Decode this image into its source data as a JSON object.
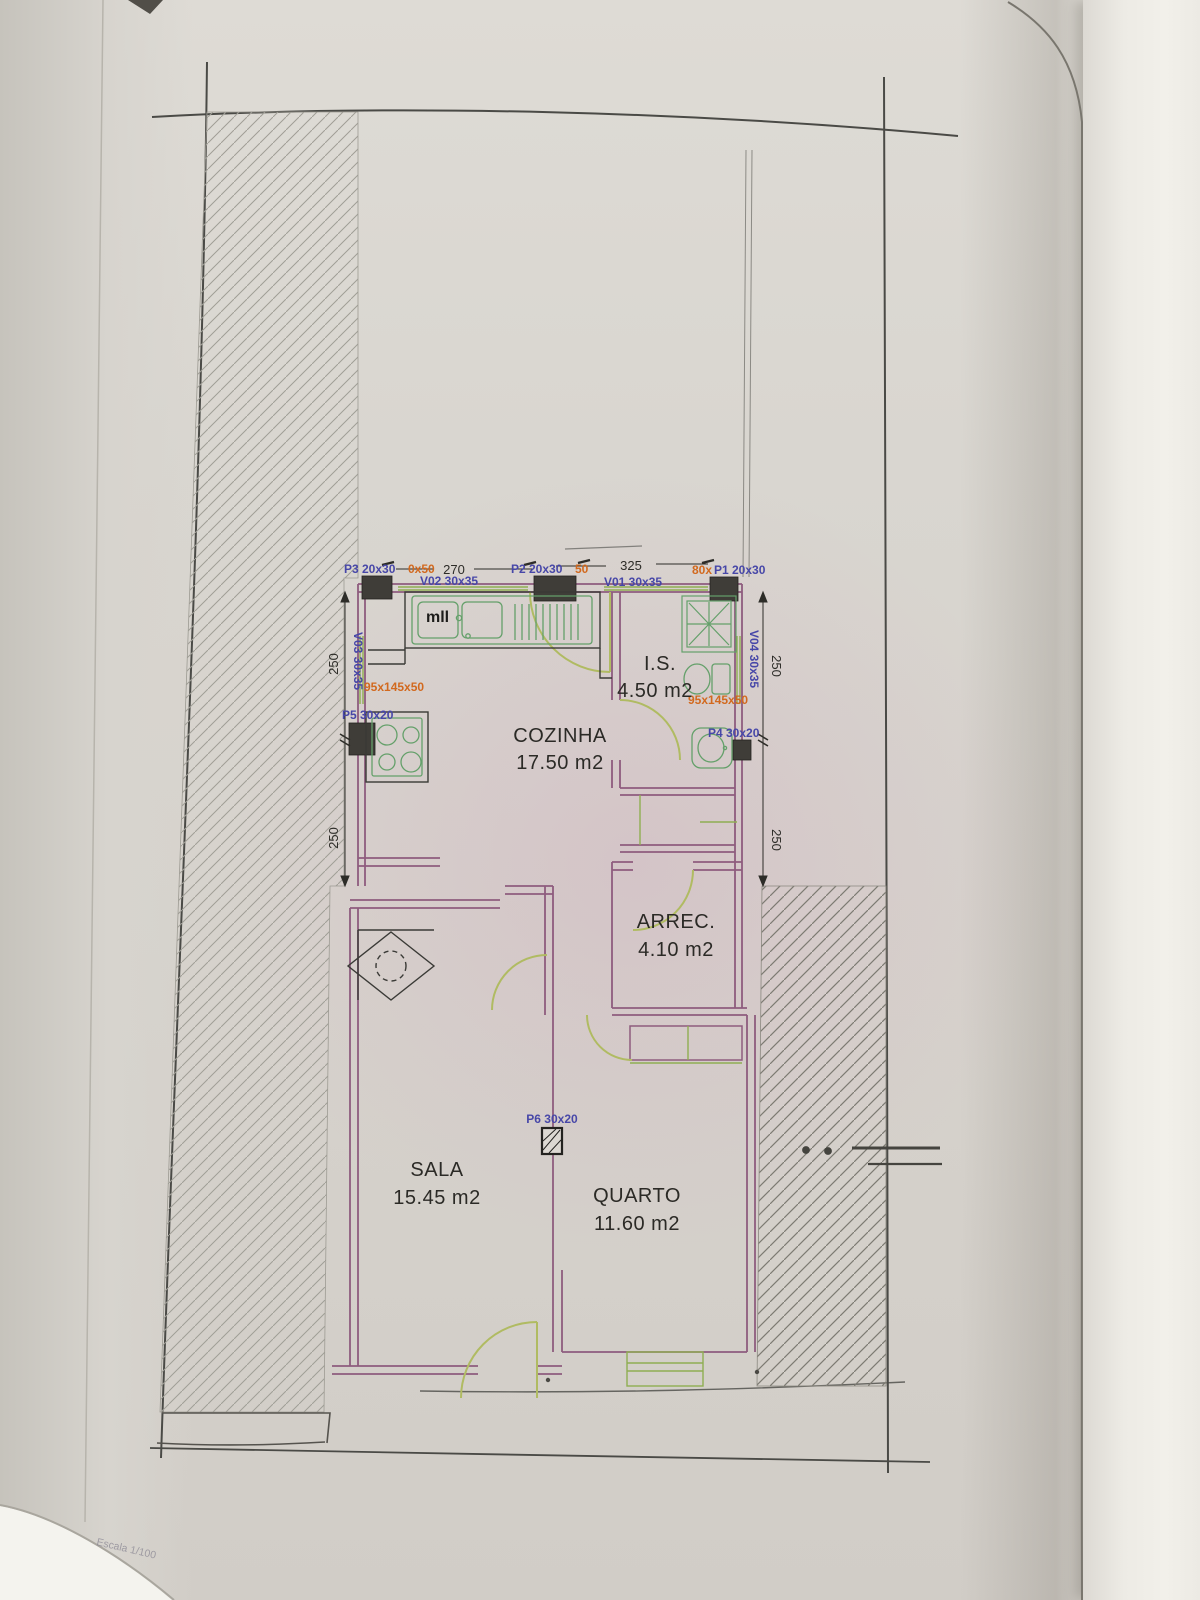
{
  "document": {
    "kind": "architectural floor plan photograph",
    "scale_note": "Escala 1/100"
  },
  "rooms": [
    {
      "name": "COZINHA",
      "area": "17.50 m2"
    },
    {
      "name": "I.S.",
      "area": "4.50 m2"
    },
    {
      "name": "ARREC.",
      "area": "4.10 m2"
    },
    {
      "name": "SALA",
      "area": "15.45 m2"
    },
    {
      "name": "QUARTO",
      "area": "11.60 m2"
    }
  ],
  "doors": [
    {
      "label": "P3 20x30",
      "extra": "0x50"
    },
    {
      "label": "P2 20x30",
      "extra": "50"
    },
    {
      "label": "P1 20x30",
      "extra": "80x"
    },
    {
      "label": "P4 30x20",
      "extra": ""
    },
    {
      "label": "P5 30x20",
      "extra": ""
    },
    {
      "label": "P6 30x20",
      "extra": ""
    }
  ],
  "windows": [
    {
      "label": "V01 30x35"
    },
    {
      "label": "V02 30x35"
    },
    {
      "label": "V03 30x35"
    },
    {
      "label": "V04 30x35"
    }
  ],
  "dimensions": {
    "top_left": "270",
    "top_right": "325",
    "left_upper": "250",
    "left_lower": "250",
    "right_upper": "250",
    "right_lower": "250"
  },
  "annotations": {
    "kitchen_note": "mll",
    "lintel_left": "95x145x50",
    "lintel_right": "95x145x50"
  },
  "colors": {
    "wall": "#8e5c7e",
    "fixture_green": "#64a06a",
    "door_arc_green": "#b0bb62",
    "label_blue": "#4747a8",
    "label_orange": "#d2691e",
    "pillar": "#3f3d38",
    "dimension": "#2d2c28"
  }
}
